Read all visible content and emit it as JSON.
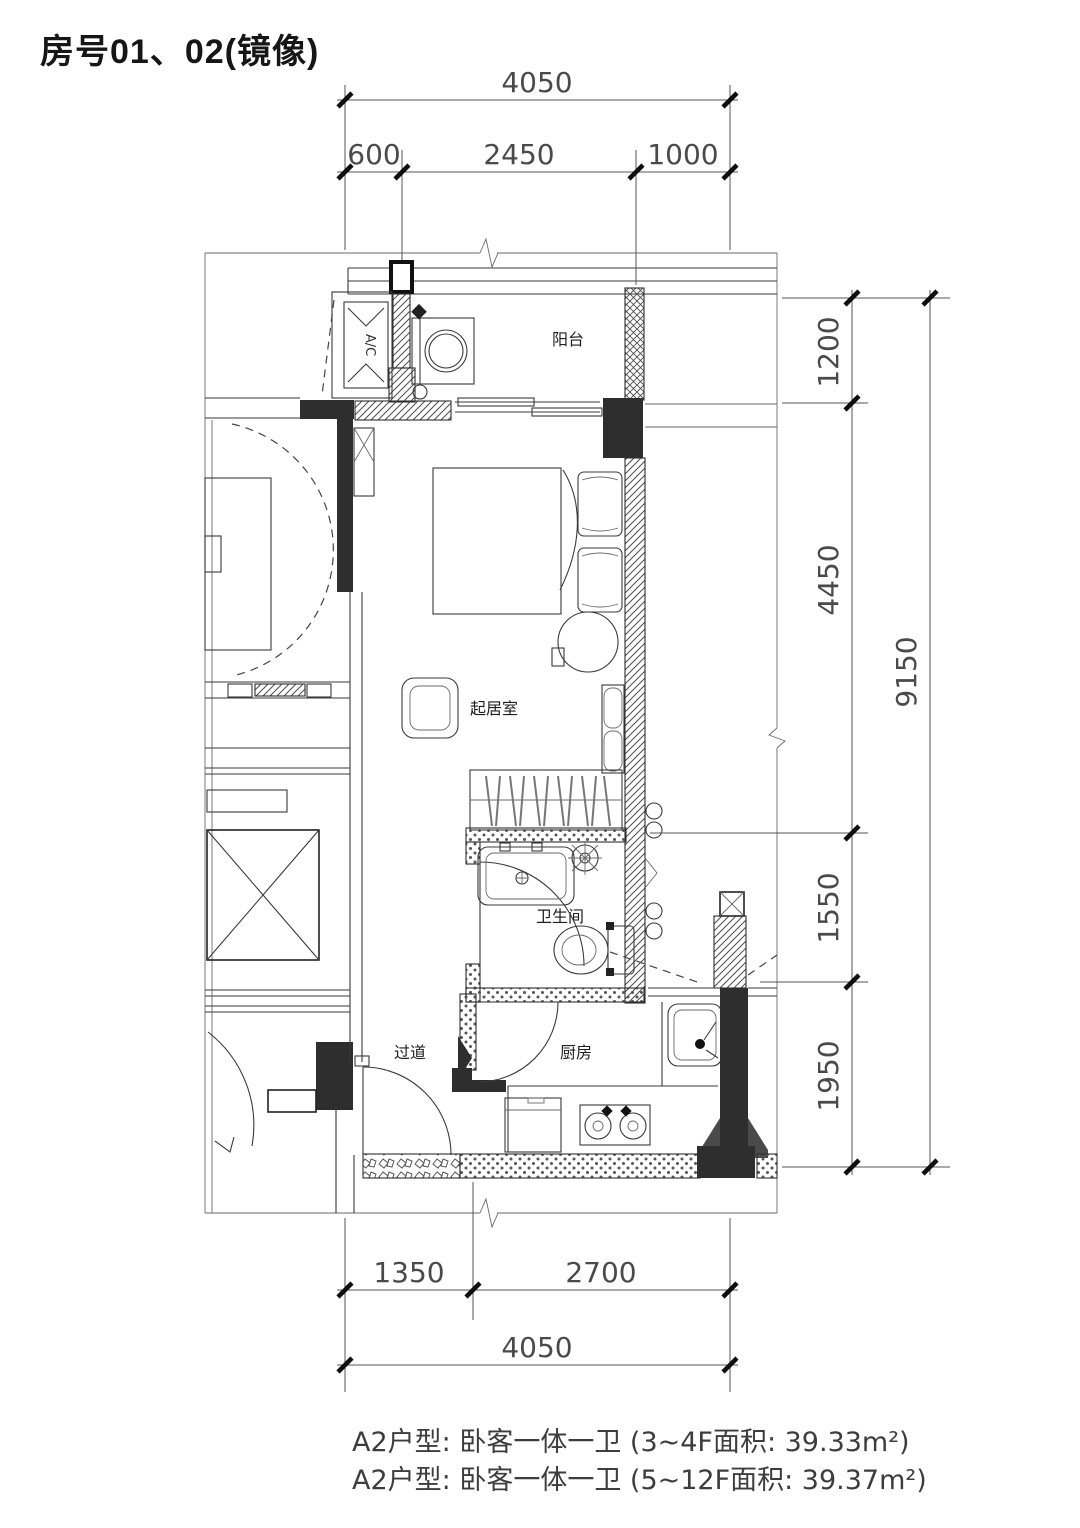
{
  "title": "房号01、02(镜像)",
  "rooms": {
    "balcony": "阳台",
    "living": "起居室",
    "bathroom": "卫生间",
    "corridor": "过道",
    "kitchen": "厨房"
  },
  "equipment": {
    "ac": "A/C"
  },
  "dimensions": {
    "top": {
      "overall": "4050",
      "segments": [
        "600",
        "2450",
        "1000"
      ]
    },
    "right": {
      "overall": "9150",
      "segments": [
        "1200",
        "4450",
        "1550",
        "1950"
      ]
    },
    "bottom": {
      "overall": "4050",
      "segments": [
        "1350",
        "2700"
      ]
    }
  },
  "notes": [
    "A2户型: 卧客一体一卫 (3~4F面积: 39.33m²)",
    "A2户型: 卧客一体一卫 (5~12F面积: 39.37m²)"
  ],
  "colors": {
    "background": "#ffffff",
    "line": "#2a2a2a",
    "wall_fill": "#2e2e2e",
    "dimension_text": "#4a4a4a"
  }
}
